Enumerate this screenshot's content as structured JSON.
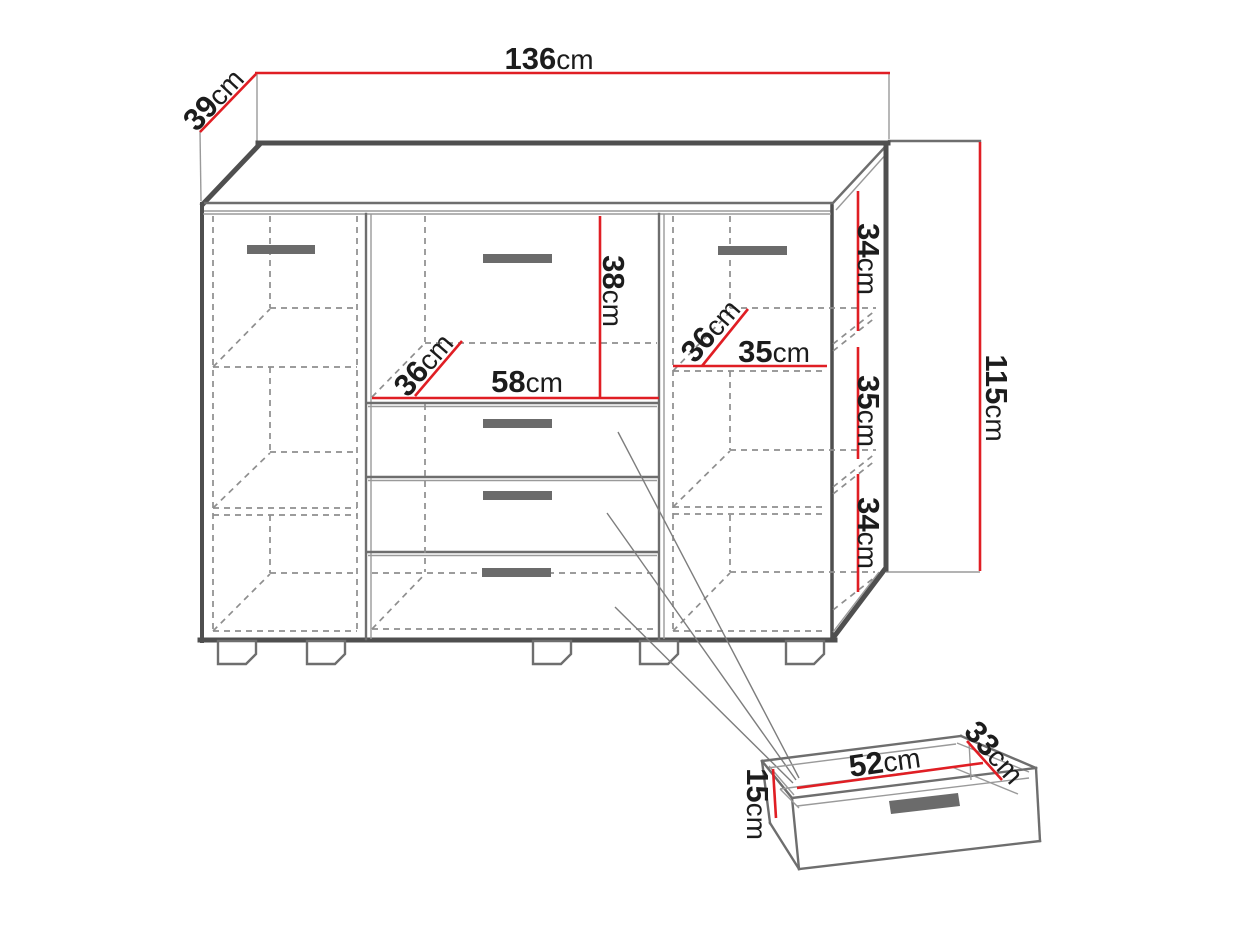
{
  "unit": "cm",
  "dims": {
    "overall_width": "136",
    "top_depth": "39",
    "overall_height": "115",
    "middle_opening_height": "38",
    "middle_opening_width": "58",
    "middle_opening_depth": "36",
    "right_opening_depth": "36",
    "right_opening_width": "35",
    "right_compartment_top_height": "34",
    "right_compartment_middle_height": "35",
    "right_compartment_bottom_height": "34",
    "drawer_inner_width": "52",
    "drawer_inner_depth": "33",
    "drawer_inner_height": "15"
  },
  "colors": {
    "dimension": "#e01e24",
    "outline": "#4f4f4f",
    "line_medium": "#6e6e6e",
    "dashed": "#8e8e8e",
    "handle": "#6b6b6b",
    "text": "#1c1c1c",
    "background": "#ffffff"
  }
}
